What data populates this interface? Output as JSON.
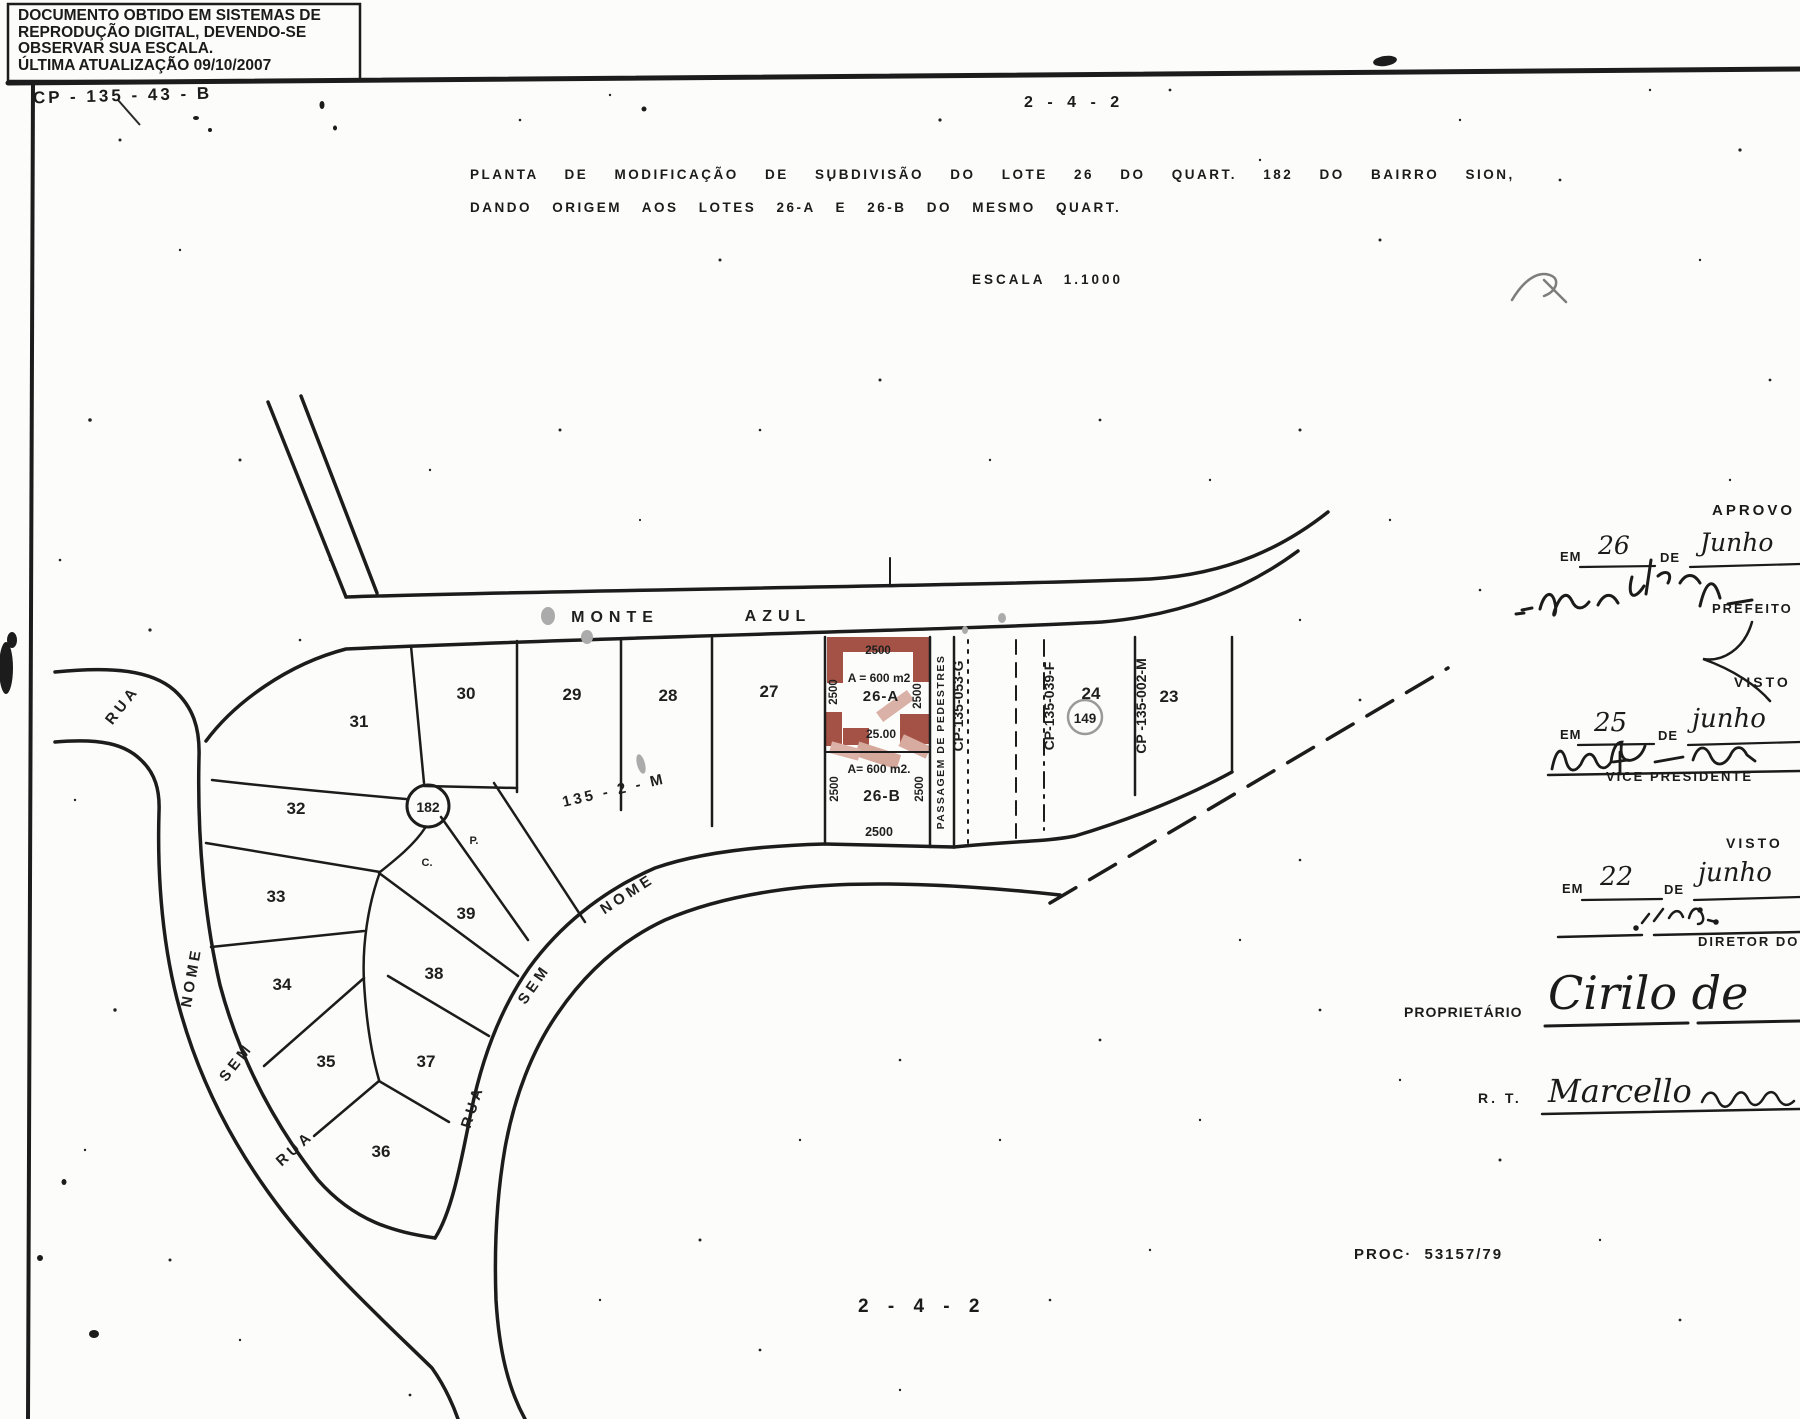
{
  "scan_notice": {
    "line1": "DOCUMENTO OBTIDO EM SISTEMAS DE",
    "line2": "REPRODUÇÃO DIGITAL, DEVENDO-SE",
    "line3": "OBSERVAR SUA ESCALA.",
    "line4": "ÚLTIMA ATUALIZAÇÃO 09/10/2007"
  },
  "codes": {
    "cp_stamp": "CP - 135 - 43 - B",
    "sheet_top": "2 - 4 - 2",
    "sheet_bottom": "2 - 4 - 2",
    "process": "PROC·  53157/79"
  },
  "title": {
    "line1": "PLANTA DE MODIFICAÇÃO DE SUBDIVISÃO DO LOTE 26 DO QUART. 182 DO BAIRRO SION,",
    "line2": "DANDO ORIGEM AOS LOTES 26-A E 26-B DO MESMO QUART.",
    "scale": "ESCALA 1.1000"
  },
  "map": {
    "streets": {
      "monte": "MONTE",
      "azul": "AZUL",
      "rua": "RUA",
      "sem": "SEM",
      "nome": "NOME"
    },
    "lots": {
      "l23": "23",
      "l24": "24",
      "l27": "27",
      "l28": "28",
      "l29": "29",
      "l30": "30",
      "l31": "31",
      "l32": "32",
      "l33": "33",
      "l34": "34",
      "l35": "35",
      "l36": "36",
      "l37": "37",
      "l38": "38",
      "l39": "39"
    },
    "lot26a": {
      "label": "26-A",
      "area": "A = 600 m2",
      "dim_top": "2500",
      "dim_left": "2500",
      "dim_right": "2500",
      "dim_bottom": "25.00"
    },
    "lot26b": {
      "label": "26-B",
      "area": "A= 600 m2.",
      "dim_left": "2500",
      "dim_right": "2500",
      "dim_bottom": "2500"
    },
    "passage": "PASSAGEM DE PEDESTRES",
    "cp_053": "CP-135-053-G",
    "cp_039": "CP-135-039-F",
    "cp_002": "CP -135-002-M",
    "block_code": "135 - 2 - M",
    "quart_main": "182",
    "quart_adjacent": "149",
    "point_c": "C.",
    "point_p": "P."
  },
  "approvals": {
    "aprovo": "APROVO",
    "em": "EM",
    "de": "DE",
    "rows": [
      {
        "day": "26",
        "month": "Junho"
      },
      {
        "day": "25",
        "month": "junho"
      },
      {
        "day": "22",
        "month": "junho"
      }
    ],
    "prefeito": "PREFEITO",
    "visto": "VISTO",
    "vice_presidente": "VICE  PRESIDENTE",
    "diretor": "DIRETOR  DO",
    "proprietario_label": "PROPRIETÁRIO",
    "proprietario_name": "Cirilo de",
    "rt_label": "R. T.",
    "rt_name": "Marcello"
  },
  "colors": {
    "highlight_red": "#9b4033",
    "highlight_pink": "#d5a89c",
    "muted_gray": "#909090",
    "ink": "#1b1b1b"
  }
}
